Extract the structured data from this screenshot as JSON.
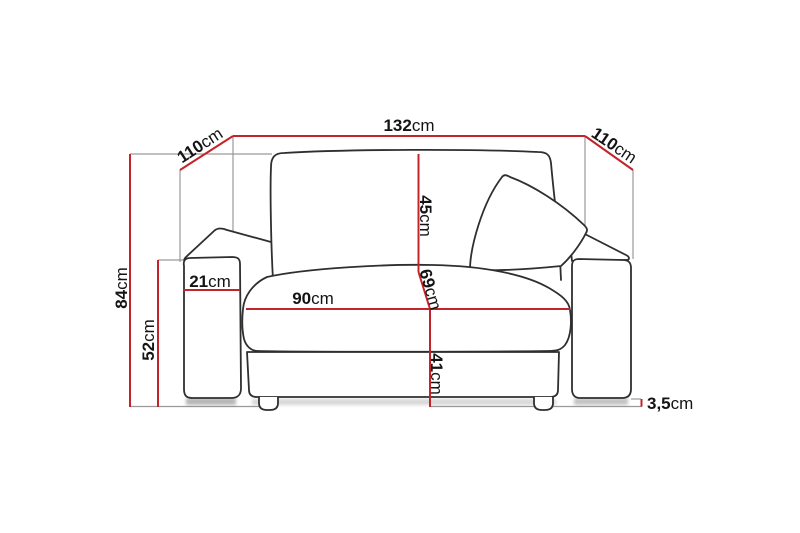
{
  "diagram": {
    "type": "sofa-dimensions",
    "unit": "cm",
    "colors": {
      "outline": "#2f2f2f",
      "dimension": "#c3242b",
      "extension": "#9a9a9a",
      "text": "#141414",
      "shadow": "#7a7a7a",
      "background": "#ffffff"
    },
    "labels": {
      "total_width": {
        "value": "132",
        "unit": "cm"
      },
      "depth_left": {
        "value": "110",
        "unit": "cm"
      },
      "depth_right": {
        "value": "110",
        "unit": "cm"
      },
      "total_height": {
        "value": "84",
        "unit": "cm"
      },
      "armrest_height": {
        "value": "52",
        "unit": "cm"
      },
      "armrest_width": {
        "value": "21",
        "unit": "cm"
      },
      "backrest_height": {
        "value": "45",
        "unit": "cm"
      },
      "seat_depth": {
        "value": "69",
        "unit": "cm"
      },
      "seat_width": {
        "value": "90",
        "unit": "cm"
      },
      "seat_height": {
        "value": "41",
        "unit": "cm"
      },
      "leg_height": {
        "value": "3,5",
        "unit": "cm"
      }
    }
  }
}
